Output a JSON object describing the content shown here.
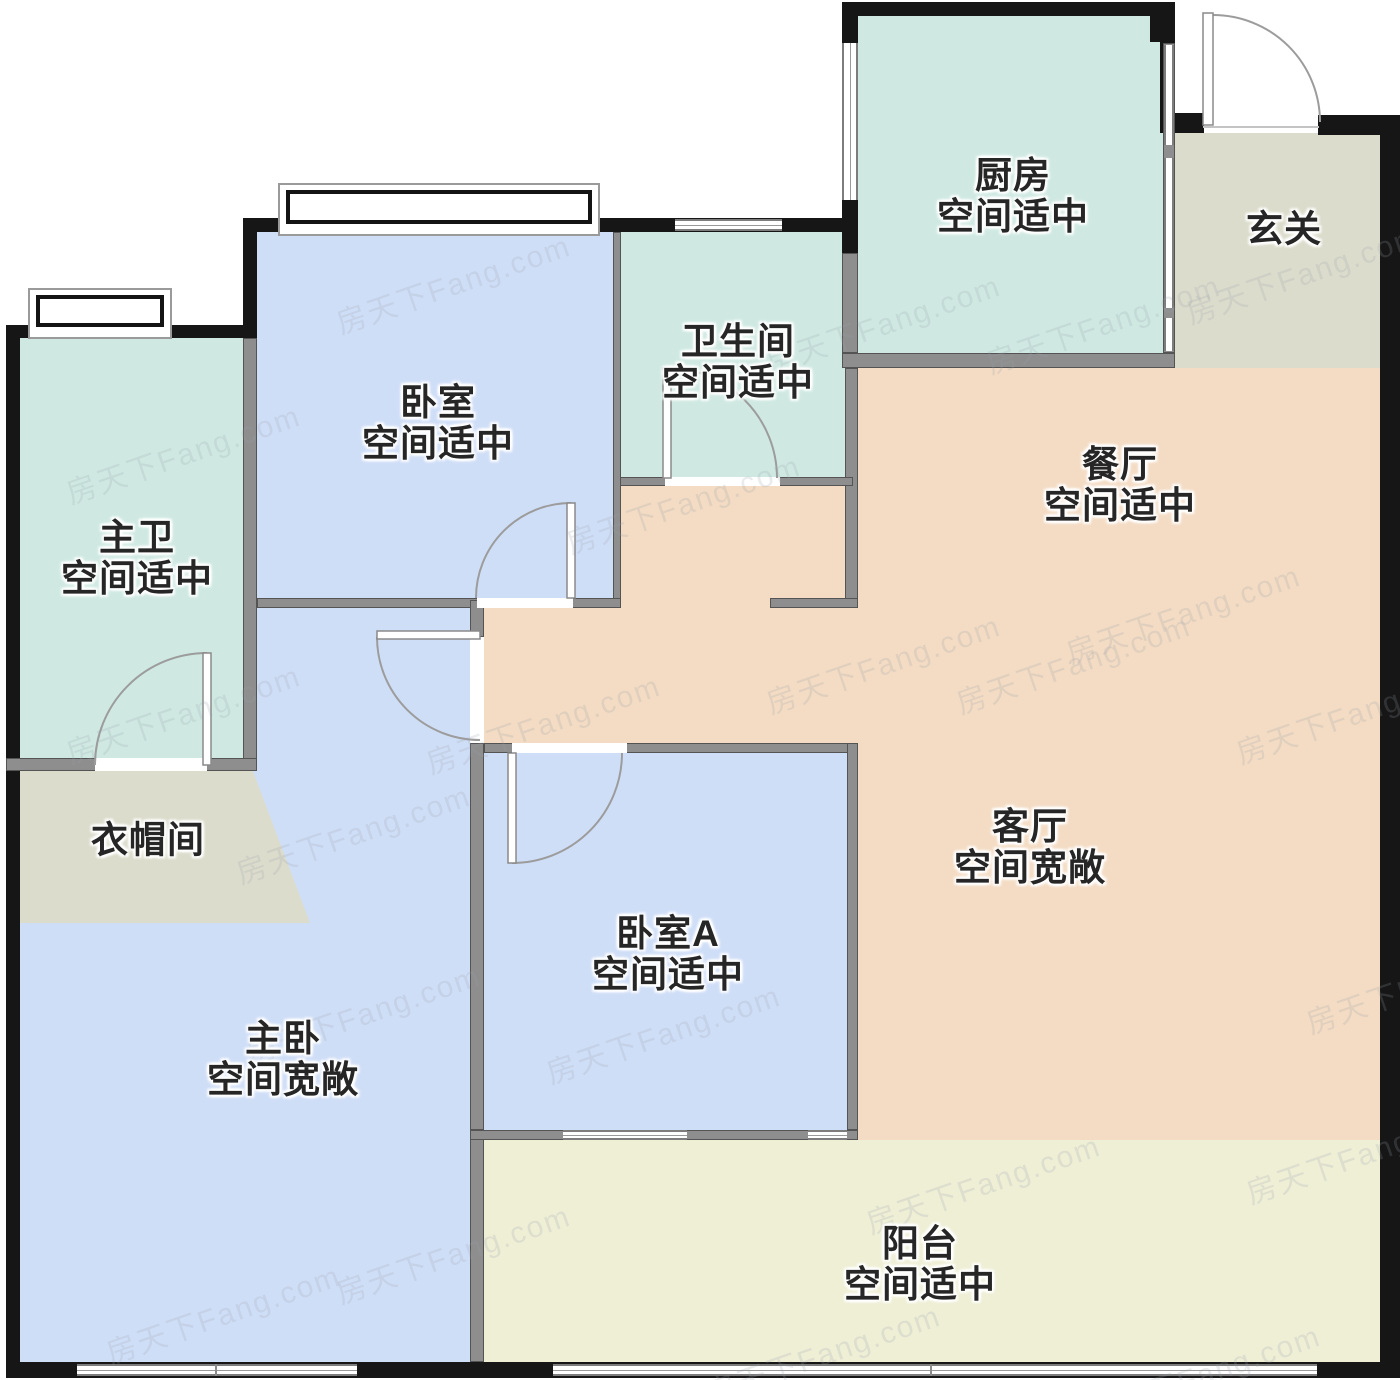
{
  "palette": {
    "outside": "#ffffff",
    "mint": "#cfe9e2",
    "blue": "#cfdef7",
    "peach": "#f4dcc4",
    "beige": "#dcdccc",
    "cream": "#efefd6",
    "wallDark": "#161616",
    "wallGray": "#8e8e8e",
    "label": "#262626",
    "watermark": "#9aa0aa"
  },
  "rooms": [
    {
      "id": "kitchen",
      "name": "厨房",
      "note": "空间适中"
    },
    {
      "id": "entry",
      "name": "玄关",
      "note": ""
    },
    {
      "id": "bathroom",
      "name": "卫生间",
      "note": "空间适中"
    },
    {
      "id": "bedroom",
      "name": "卧室",
      "note": "空间适中"
    },
    {
      "id": "master-bath",
      "name": "主卫",
      "note": "空间适中"
    },
    {
      "id": "dining",
      "name": "餐厅",
      "note": "空间适中"
    },
    {
      "id": "closet",
      "name": "衣帽间",
      "note": ""
    },
    {
      "id": "living",
      "name": "客厅",
      "note": "空间宽敞"
    },
    {
      "id": "bedroom-a",
      "name": "卧室A",
      "note": "空间适中"
    },
    {
      "id": "master-bedroom",
      "name": "主卧",
      "note": "空间宽敞"
    },
    {
      "id": "balcony",
      "name": "阳台",
      "note": "空间适中"
    }
  ],
  "watermark": {
    "text": "房天下Fang.com",
    "positions": [
      [
        60,
        430
      ],
      [
        60,
        690
      ],
      [
        100,
        1290
      ],
      [
        230,
        810
      ],
      [
        240,
        990
      ],
      [
        330,
        260
      ],
      [
        420,
        700
      ],
      [
        330,
        1230
      ],
      [
        540,
        1010
      ],
      [
        560,
        480
      ],
      [
        700,
        1330
      ],
      [
        760,
        300
      ],
      [
        760,
        640
      ],
      [
        860,
        1160
      ],
      [
        950,
        640
      ],
      [
        980,
        300
      ],
      [
        1060,
        590
      ],
      [
        1080,
        1350
      ],
      [
        1180,
        250
      ],
      [
        1230,
        690
      ],
      [
        1240,
        1130
      ],
      [
        1300,
        960
      ]
    ]
  }
}
